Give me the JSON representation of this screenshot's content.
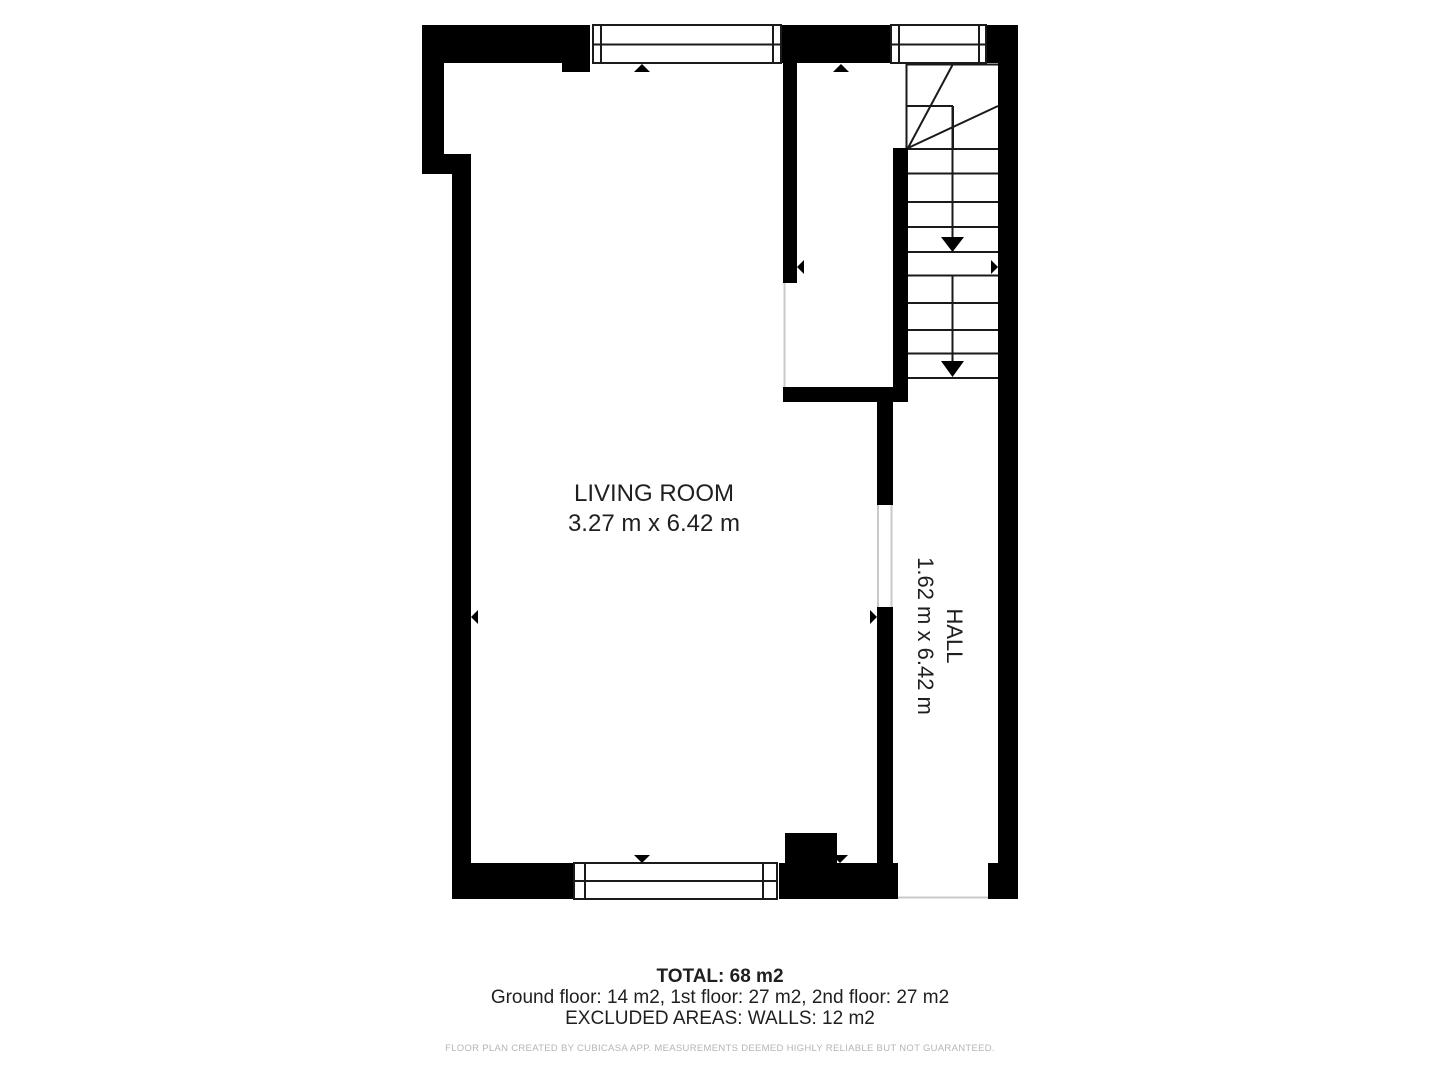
{
  "floor_plan": {
    "rooms": [
      {
        "name": "LIVING ROOM",
        "dimensions": "3.27 m x 6.42 m"
      },
      {
        "name": "HALL",
        "dimensions": "1.62 m x 6.42 m"
      }
    ],
    "footer": {
      "total": "TOTAL: 68 m2",
      "floor_breakdown": "Ground floor: 14 m2, 1st floor: 27 m2, 2nd floor: 27 m2",
      "excluded_areas": "EXCLUDED AREAS: WALLS: 12 m2",
      "disclaimer": "FLOOR PLAN CREATED BY CUBICASA APP. MEASUREMENTS DEEMED HIGHLY RELIABLE BUT NOT GUARANTEED."
    },
    "colors": {
      "wall": "#000000",
      "line": "#1a1a1a",
      "door-line": "#c9c9c9",
      "text": "#1f1f1f",
      "disclaimer": "#b5b5b5",
      "background": "#ffffff"
    }
  }
}
